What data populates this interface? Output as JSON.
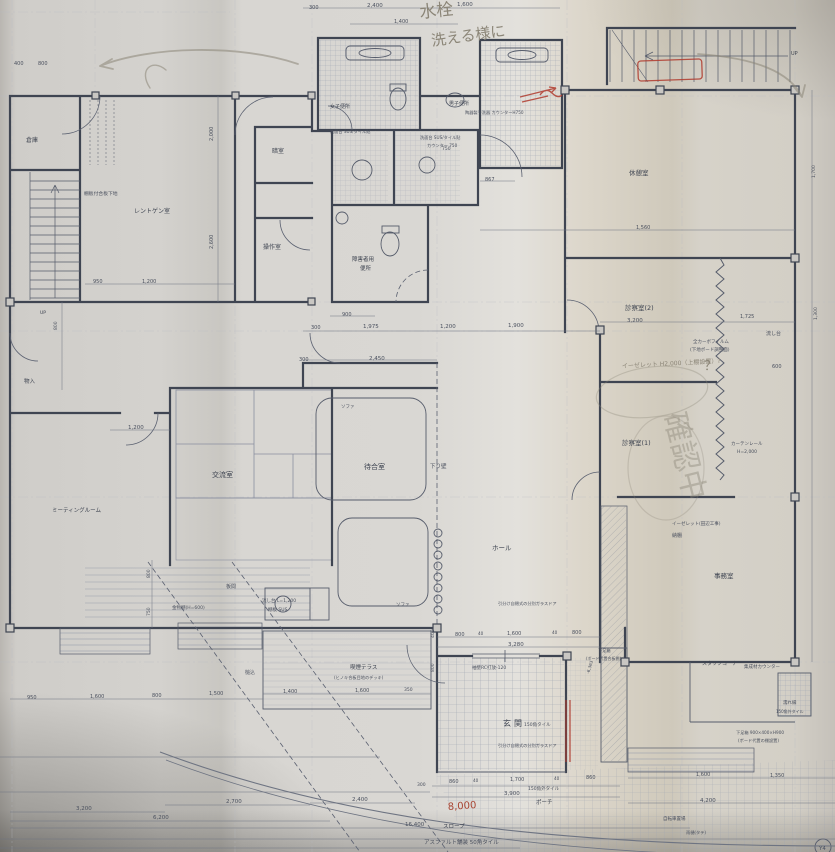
{
  "colors": {
    "paper": "#d7d4cf",
    "ink": "#555b6a",
    "wall": "#3f4552",
    "tile_line": "#9aa0ae",
    "pencil": "#8b8577",
    "red_pen": "#b03a2e"
  },
  "plan": {
    "text_groups": [
      {
        "id": "room-labels",
        "name": "room-label",
        "color": "#3d4350",
        "size": 7,
        "items": [
          {
            "text": "倉庫",
            "x": 26,
            "y": 142,
            "size": 6
          },
          {
            "text": "レントゲン室",
            "x": 134,
            "y": 213,
            "size": 6
          },
          {
            "text": "暗室",
            "x": 272,
            "y": 153,
            "size": 6
          },
          {
            "text": "操作室",
            "x": 263,
            "y": 249,
            "size": 6
          },
          {
            "text": "女子便所",
            "x": 330,
            "y": 108,
            "size": 5
          },
          {
            "text": "男子便所",
            "x": 449,
            "y": 105,
            "size": 5
          },
          {
            "text": "障害者用",
            "x": 352,
            "y": 261,
            "size": 5.5
          },
          {
            "text": "便所",
            "x": 360,
            "y": 270,
            "size": 5.5
          },
          {
            "text": "休憩室",
            "x": 629,
            "y": 175,
            "size": 6.5
          },
          {
            "text": "診察室(2)",
            "x": 625,
            "y": 310,
            "size": 6.5
          },
          {
            "text": "診察室(1)",
            "x": 622,
            "y": 445,
            "size": 6.5
          },
          {
            "text": "事務室",
            "x": 714,
            "y": 578,
            "size": 6.5
          },
          {
            "text": "ホール",
            "x": 492,
            "y": 550,
            "size": 6.5
          },
          {
            "text": "待合室",
            "x": 364,
            "y": 469,
            "size": 7
          },
          {
            "text": "交流室",
            "x": 212,
            "y": 477,
            "size": 7
          },
          {
            "text": "ミーティングルーム",
            "x": 52,
            "y": 512,
            "size": 5.5
          },
          {
            "text": "物入",
            "x": 24,
            "y": 383,
            "size": 5.5
          },
          {
            "text": "玄関",
            "x": 503,
            "y": 726,
            "size": 8,
            "spacing": 3
          },
          {
            "text": "スタッフコーナー",
            "x": 702,
            "y": 665,
            "size": 5
          },
          {
            "text": "喫煙テラス",
            "x": 350,
            "y": 669,
            "size": 5.5
          },
          {
            "text": "ポーチ",
            "x": 536,
            "y": 804,
            "size": 5.5
          },
          {
            "text": "スロープ",
            "x": 443,
            "y": 828,
            "size": 5.5
          },
          {
            "text": "UP",
            "x": 791,
            "y": 55,
            "size": 5
          },
          {
            "text": "UP",
            "x": 40,
            "y": 314,
            "size": 4.5
          }
        ]
      },
      {
        "id": "annotations",
        "name": "annotation",
        "color": "#4a505e",
        "size": 5,
        "items": [
          {
            "text": "棚板付合板下地",
            "x": 84,
            "y": 195,
            "size": 4.8
          },
          {
            "text": "洗面台 SUS/タイル貼",
            "x": 330,
            "y": 133,
            "size": 4.2
          },
          {
            "text": "洗面台 SUS/タイル貼",
            "x": 420,
            "y": 139,
            "size": 4.2
          },
          {
            "text": "カウンター 750",
            "x": 427,
            "y": 147,
            "size": 4.2
          },
          {
            "text": "陶器製手洗器 カウンターH750",
            "x": 465,
            "y": 114,
            "size": 4.2
          },
          {
            "text": "全カーボフィルム",
            "x": 693,
            "y": 343,
            "size": 4.5
          },
          {
            "text": "(下地ボード調整面)",
            "x": 690,
            "y": 351,
            "size": 4.5
          },
          {
            "text": "カーテンレール",
            "x": 731,
            "y": 445,
            "size": 4.5
          },
          {
            "text": "H=2,000",
            "x": 737,
            "y": 453,
            "size": 4.5
          },
          {
            "text": "イーゼレット(田辺工事)",
            "x": 672,
            "y": 525,
            "size": 4.5
          },
          {
            "text": "納棚",
            "x": 672,
            "y": 537,
            "size": 5
          },
          {
            "text": "流し台",
            "x": 766,
            "y": 335,
            "size": 5
          },
          {
            "text": "金物棚(H=600)",
            "x": 172,
            "y": 609,
            "size": 4.5
          },
          {
            "text": "流し台 L=1,200",
            "x": 262,
            "y": 602,
            "size": 4.5
          },
          {
            "text": "棚板 SUS",
            "x": 268,
            "y": 611,
            "size": 4.5
          },
          {
            "text": "板間",
            "x": 226,
            "y": 588,
            "size": 5
          },
          {
            "text": "下り壁",
            "x": 430,
            "y": 468,
            "size": 5.5
          },
          {
            "text": "ソファ",
            "x": 341,
            "y": 408,
            "size": 4.5
          },
          {
            "text": "ソファ",
            "x": 396,
            "y": 606,
            "size": 4.5
          },
          {
            "text": "袖壁RC打放-120",
            "x": 472,
            "y": 669,
            "size": 4.5
          },
          {
            "text": "引分け自閉式の分別ガラスドア",
            "x": 498,
            "y": 605,
            "size": 4.2
          },
          {
            "text": "引分け自閉式の分別ガラスドア",
            "x": 498,
            "y": 747,
            "size": 4.2
          },
          {
            "text": "下足箱",
            "x": 598,
            "y": 652,
            "size": 4.2
          },
          {
            "text": "(ボード代置合板棚)",
            "x": 586,
            "y": 660,
            "size": 4
          },
          {
            "text": "下足箱 900×400×H900",
            "x": 736,
            "y": 734,
            "size": 4.2
          },
          {
            "text": "(ボード代置の棚設置)",
            "x": 738,
            "y": 742,
            "size": 4.2
          },
          {
            "text": "集成材カウンター",
            "x": 744,
            "y": 668,
            "size": 4.5
          },
          {
            "text": "濡れ縁",
            "x": 783,
            "y": 704,
            "size": 4.5
          },
          {
            "text": "150角外タイル",
            "x": 776,
            "y": 713,
            "size": 4
          },
          {
            "text": "150角タイル",
            "x": 524,
            "y": 726,
            "size": 4.5
          },
          {
            "text": "150角外タイル",
            "x": 528,
            "y": 790,
            "size": 4.5
          },
          {
            "text": "アスファルト舗装 50角タイル",
            "x": 424,
            "y": 844,
            "size": 5.5
          },
          {
            "text": "自転車置場",
            "x": 663,
            "y": 820,
            "size": 4.5
          },
          {
            "text": "雨樋(タテ)",
            "x": 686,
            "y": 834,
            "size": 4.2
          },
          {
            "text": "(ヒノキ合板目地のデッキ)",
            "x": 334,
            "y": 679,
            "size": 4.2
          },
          {
            "text": "槌込",
            "x": 245,
            "y": 674,
            "size": 5
          },
          {
            "text": "Y4",
            "x": 819,
            "y": 850,
            "size": 5.5
          }
        ]
      },
      {
        "id": "dimensions",
        "name": "dimension",
        "color": "#4a505e",
        "size": 5.5,
        "items": [
          {
            "text": "300",
            "x": 309,
            "y": 9,
            "size": 5
          },
          {
            "text": "2,400",
            "x": 367,
            "y": 7
          },
          {
            "text": "1,600",
            "x": 457,
            "y": 6
          },
          {
            "text": "1,400",
            "x": 394,
            "y": 23,
            "size": 5
          },
          {
            "text": "400",
            "x": 14,
            "y": 65,
            "size": 5
          },
          {
            "text": "800",
            "x": 38,
            "y": 65,
            "size": 5
          },
          {
            "text": "867",
            "x": 485,
            "y": 181,
            "size": 5
          },
          {
            "text": "750",
            "x": 442,
            "y": 150,
            "size": 4.5
          },
          {
            "text": "1,560",
            "x": 636,
            "y": 229,
            "size": 5
          },
          {
            "text": "2,000",
            "x": 213,
            "y": 141,
            "rot": -90,
            "size": 5
          },
          {
            "text": "2,600",
            "x": 213,
            "y": 249,
            "rot": -90,
            "size": 5
          },
          {
            "text": "800",
            "x": 57,
            "y": 330,
            "rot": -90,
            "size": 4.5
          },
          {
            "text": "800",
            "x": 150,
            "y": 578,
            "rot": -90,
            "size": 4.5
          },
          {
            "text": "750",
            "x": 150,
            "y": 616,
            "rot": -90,
            "size": 4.5
          },
          {
            "text": "400",
            "x": 434,
            "y": 638,
            "rot": -90,
            "size": 4.5
          },
          {
            "text": "800",
            "x": 434,
            "y": 672,
            "rot": -90,
            "size": 4.5
          },
          {
            "text": "600",
            "x": 772,
            "y": 368,
            "size": 5
          },
          {
            "text": "900",
            "x": 342,
            "y": 316,
            "size": 5
          },
          {
            "text": "300",
            "x": 311,
            "y": 329,
            "size": 5
          },
          {
            "text": "1,975",
            "x": 363,
            "y": 328
          },
          {
            "text": "1,200",
            "x": 440,
            "y": 328
          },
          {
            "text": "1,900",
            "x": 508,
            "y": 327
          },
          {
            "text": "950",
            "x": 93,
            "y": 283,
            "size": 5
          },
          {
            "text": "1,200",
            "x": 142,
            "y": 283,
            "size": 5
          },
          {
            "text": "300",
            "x": 299,
            "y": 361,
            "size": 5
          },
          {
            "text": "2,450",
            "x": 369,
            "y": 360
          },
          {
            "text": "1,200",
            "x": 128,
            "y": 429
          },
          {
            "text": "3,200",
            "x": 627,
            "y": 322
          },
          {
            "text": "1,725",
            "x": 740,
            "y": 318,
            "size": 5
          },
          {
            "text": "1,700",
            "x": 815,
            "y": 178,
            "rot": -90,
            "size": 4.5
          },
          {
            "text": "1,300",
            "x": 817,
            "y": 320,
            "rot": -90,
            "size": 4.5
          },
          {
            "text": "800",
            "x": 455,
            "y": 636,
            "size": 5
          },
          {
            "text": "40",
            "x": 478,
            "y": 635,
            "size": 4.2
          },
          {
            "text": "1,600",
            "x": 507,
            "y": 635,
            "size": 5
          },
          {
            "text": "40",
            "x": 552,
            "y": 634,
            "size": 4.2
          },
          {
            "text": "800",
            "x": 572,
            "y": 634,
            "size": 5
          },
          {
            "text": "3,280",
            "x": 508,
            "y": 646
          },
          {
            "text": "1,400",
            "x": 283,
            "y": 693,
            "size": 5
          },
          {
            "text": "1,600",
            "x": 355,
            "y": 692,
            "size": 5
          },
          {
            "text": "350",
            "x": 404,
            "y": 691,
            "size": 4.5
          },
          {
            "text": "950",
            "x": 27,
            "y": 699,
            "size": 5
          },
          {
            "text": "1,600",
            "x": 90,
            "y": 698,
            "size": 5
          },
          {
            "text": "800",
            "x": 152,
            "y": 697,
            "size": 5
          },
          {
            "text": "1,500",
            "x": 209,
            "y": 695,
            "size": 5
          },
          {
            "text": "3,200",
            "x": 76,
            "y": 810
          },
          {
            "text": "6,200",
            "x": 153,
            "y": 819
          },
          {
            "text": "2,700",
            "x": 226,
            "y": 803
          },
          {
            "text": "2,400",
            "x": 352,
            "y": 801
          },
          {
            "text": "16,400",
            "x": 405,
            "y": 826
          },
          {
            "text": "300",
            "x": 417,
            "y": 786,
            "size": 4.5
          },
          {
            "text": "860",
            "x": 449,
            "y": 783,
            "size": 5
          },
          {
            "text": "40",
            "x": 473,
            "y": 782,
            "size": 4.2
          },
          {
            "text": "1,700",
            "x": 510,
            "y": 781,
            "size": 5
          },
          {
            "text": "40",
            "x": 554,
            "y": 780,
            "size": 4.2
          },
          {
            "text": "860",
            "x": 586,
            "y": 779,
            "size": 5
          },
          {
            "text": "3,900",
            "x": 504,
            "y": 795
          },
          {
            "text": "1,600",
            "x": 696,
            "y": 776,
            "size": 5
          },
          {
            "text": "1,350",
            "x": 770,
            "y": 777,
            "size": 5
          },
          {
            "text": "4,200",
            "x": 700,
            "y": 802
          },
          {
            "text": "-6,363",
            "x": 589,
            "y": 674,
            "rot": -72,
            "size": 4.2
          }
        ]
      },
      {
        "id": "handwritten",
        "name": "handwritten-note",
        "color": "#8b8577",
        "size": 14,
        "items": [
          {
            "text": "水栓",
            "x": 420,
            "y": 18,
            "size": 17,
            "rot": -6
          },
          {
            "text": "洗える様に",
            "x": 432,
            "y": 46,
            "size": 15,
            "rot": -8
          },
          {
            "text": "イーゼレット H2,000（上棚設置）?",
            "x": 622,
            "y": 368,
            "size": 6,
            "rot": -3
          },
          {
            "text": "確認中",
            "x": 664,
            "y": 415,
            "size": 30,
            "rot": 76,
            "opacity": 0.42
          },
          {
            "text": "？",
            "x": 704,
            "y": 370,
            "size": 13
          },
          {
            "text": "8,000",
            "x": 448,
            "y": 810,
            "size": 10,
            "rot": -4,
            "color": "#a84432"
          }
        ]
      }
    ]
  }
}
